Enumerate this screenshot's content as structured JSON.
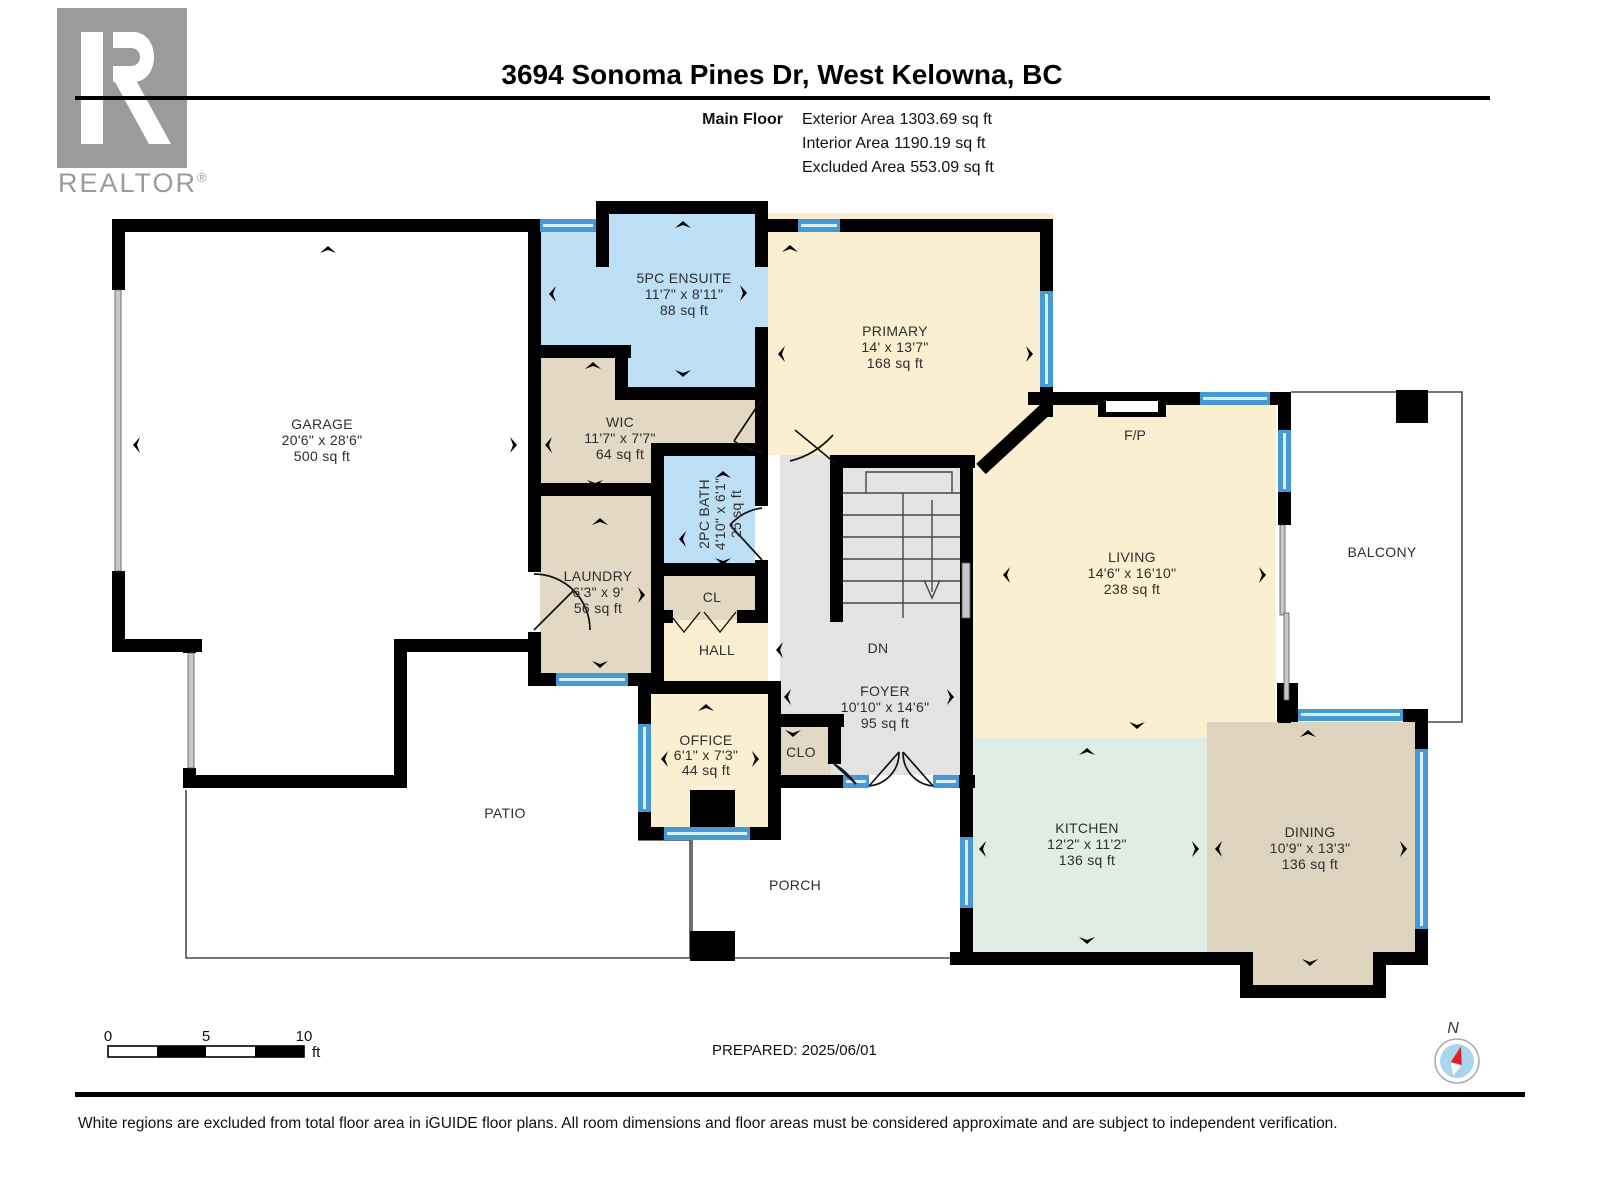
{
  "header": {
    "logo": {
      "brand": "REALTOR",
      "registered": "®"
    },
    "title": "3694 Sonoma Pines Dr, West Kelowna, BC",
    "floor_label": "Main Floor",
    "areas": [
      {
        "label": "Exterior Area",
        "value": "1303.69 sq ft"
      },
      {
        "label": "Interior Area",
        "value": "1190.19 sq ft"
      },
      {
        "label": "Excluded Area",
        "value": "553.09 sq ft"
      }
    ]
  },
  "rooms": {
    "garage": {
      "name": "GARAGE",
      "dims": "20'6\" x 28'6\"",
      "area": "500 sq ft"
    },
    "ensuite": {
      "name": "5PC ENSUITE",
      "dims": "11'7\" x 8'11\"",
      "area": "88 sq ft"
    },
    "primary": {
      "name": "PRIMARY",
      "dims": "14' x 13'7\"",
      "area": "168 sq ft"
    },
    "wic": {
      "name": "WIC",
      "dims": "11'7\" x 7'7\"",
      "area": "64 sq ft"
    },
    "bath2pc": {
      "name": "2PC BATH",
      "dims": "4'10\" x 6'1\"",
      "area": "25 sq ft"
    },
    "laundry": {
      "name": "LAUNDRY",
      "dims": "6'3\" x 9'",
      "area": "56 sq ft"
    },
    "cl": {
      "name": "CL"
    },
    "hall": {
      "name": "HALL"
    },
    "office": {
      "name": "OFFICE",
      "dims": "6'1\" x 7'3\"",
      "area": "44 sq ft"
    },
    "clo": {
      "name": "CLO"
    },
    "foyer": {
      "name": "FOYER",
      "dims": "10'10\" x 14'6\"",
      "area": "95 sq ft"
    },
    "stairs": {
      "label": "DN"
    },
    "living": {
      "name": "LIVING",
      "dims": "14'6\" x 16'10\"",
      "area": "238 sq ft"
    },
    "fireplace": {
      "name": "F/P"
    },
    "balcony": {
      "name": "BALCONY"
    },
    "patio": {
      "name": "PATIO"
    },
    "porch": {
      "name": "PORCH"
    },
    "kitchen": {
      "name": "KITCHEN",
      "dims": "12'2\" x 11'2\"",
      "area": "136 sq ft"
    },
    "dining": {
      "name": "DINING",
      "dims": "10'9\" x 13'3\"",
      "area": "136 sq ft"
    }
  },
  "footer": {
    "scale": {
      "t0": "0",
      "t5": "5",
      "t10": "10",
      "unit": "ft"
    },
    "prepared": "PREPARED: 2025/06/01",
    "compass_label": "N",
    "disclaimer": "White regions are excluded from total floor area in iGUIDE floor plans. All room dimensions and floor areas must be considered approximate and are subject to independent verification."
  },
  "colors": {
    "wall": "#000000",
    "cream": "#FAEFD1",
    "tan": "#E2D8C3",
    "tan_dining": "#DED3BE",
    "blue_room": "#BCDFF5",
    "mint": "#DFEDE5",
    "gray_floor": "#E3E3E3",
    "window_blue": "#4599D6",
    "logo_gray": "#9B9B9B",
    "compass_blue": "#A9D6EF",
    "compass_red": "#E02020"
  }
}
